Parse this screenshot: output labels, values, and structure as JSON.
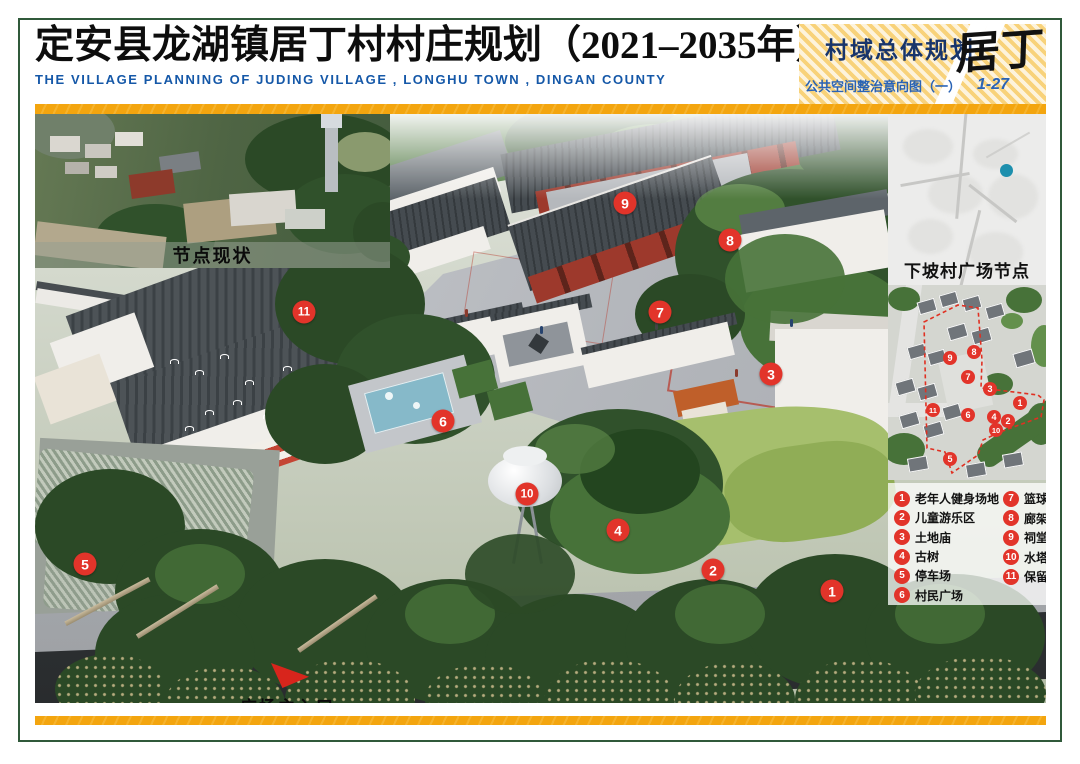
{
  "header": {
    "title": "定安县龙湖镇居丁村村庄规划（2021–2035年）",
    "subtitle": "THE VILLAGE PLANNING OF JUDING VILLAGE , LONGHU TOWN , DINGAN COUNTY",
    "plan_type": "村域总体规划",
    "sheet_name": "公共空间整治意向图（一）",
    "sheet_no": "1-27",
    "logo": "居丁"
  },
  "insets": {
    "photo_label": "节点现状",
    "map_label": "下坡村广场节点"
  },
  "annotations": {
    "entrance_label": "广场主入口"
  },
  "legend": {
    "items": [
      {
        "num": "1",
        "label": "老年人健身场地"
      },
      {
        "num": "2",
        "label": "儿童游乐区"
      },
      {
        "num": "3",
        "label": "土地庙"
      },
      {
        "num": "4",
        "label": "古树"
      },
      {
        "num": "5",
        "label": "停车场"
      },
      {
        "num": "6",
        "label": "村民广场"
      },
      {
        "num": "7",
        "label": "篮球场"
      },
      {
        "num": "8",
        "label": "廊架"
      },
      {
        "num": "9",
        "label": "祠堂"
      },
      {
        "num": "10",
        "label": "水塔"
      },
      {
        "num": "11",
        "label": "保留建筑"
      }
    ]
  },
  "markers": {
    "main": [
      {
        "num": "1",
        "x": 797,
        "y": 477
      },
      {
        "num": "2",
        "x": 678,
        "y": 456
      },
      {
        "num": "3",
        "x": 736,
        "y": 260
      },
      {
        "num": "4",
        "x": 583,
        "y": 416
      },
      {
        "num": "5",
        "x": 50,
        "y": 450
      },
      {
        "num": "6",
        "x": 408,
        "y": 307
      },
      {
        "num": "7",
        "x": 625,
        "y": 198
      },
      {
        "num": "8",
        "x": 695,
        "y": 126
      },
      {
        "num": "9",
        "x": 590,
        "y": 89
      },
      {
        "num": "10",
        "x": 492,
        "y": 380
      },
      {
        "num": "11",
        "x": 269,
        "y": 198
      }
    ],
    "plan": [
      {
        "num": "1",
        "x": 132,
        "y": 118
      },
      {
        "num": "2",
        "x": 120,
        "y": 136
      },
      {
        "num": "3",
        "x": 102,
        "y": 104
      },
      {
        "num": "4",
        "x": 106,
        "y": 132
      },
      {
        "num": "5",
        "x": 62,
        "y": 174
      },
      {
        "num": "6",
        "x": 80,
        "y": 130
      },
      {
        "num": "7",
        "x": 80,
        "y": 92
      },
      {
        "num": "8",
        "x": 86,
        "y": 67
      },
      {
        "num": "9",
        "x": 62,
        "y": 73
      },
      {
        "num": "10",
        "x": 108,
        "y": 145
      },
      {
        "num": "11",
        "x": 45,
        "y": 125
      }
    ]
  },
  "colors": {
    "accent_red": "#e2342a",
    "bar_yellow": "#f3a50f",
    "frame_green": "#30593a",
    "title_blue": "#1558a8",
    "map_dot_teal": "#1d8fad"
  }
}
